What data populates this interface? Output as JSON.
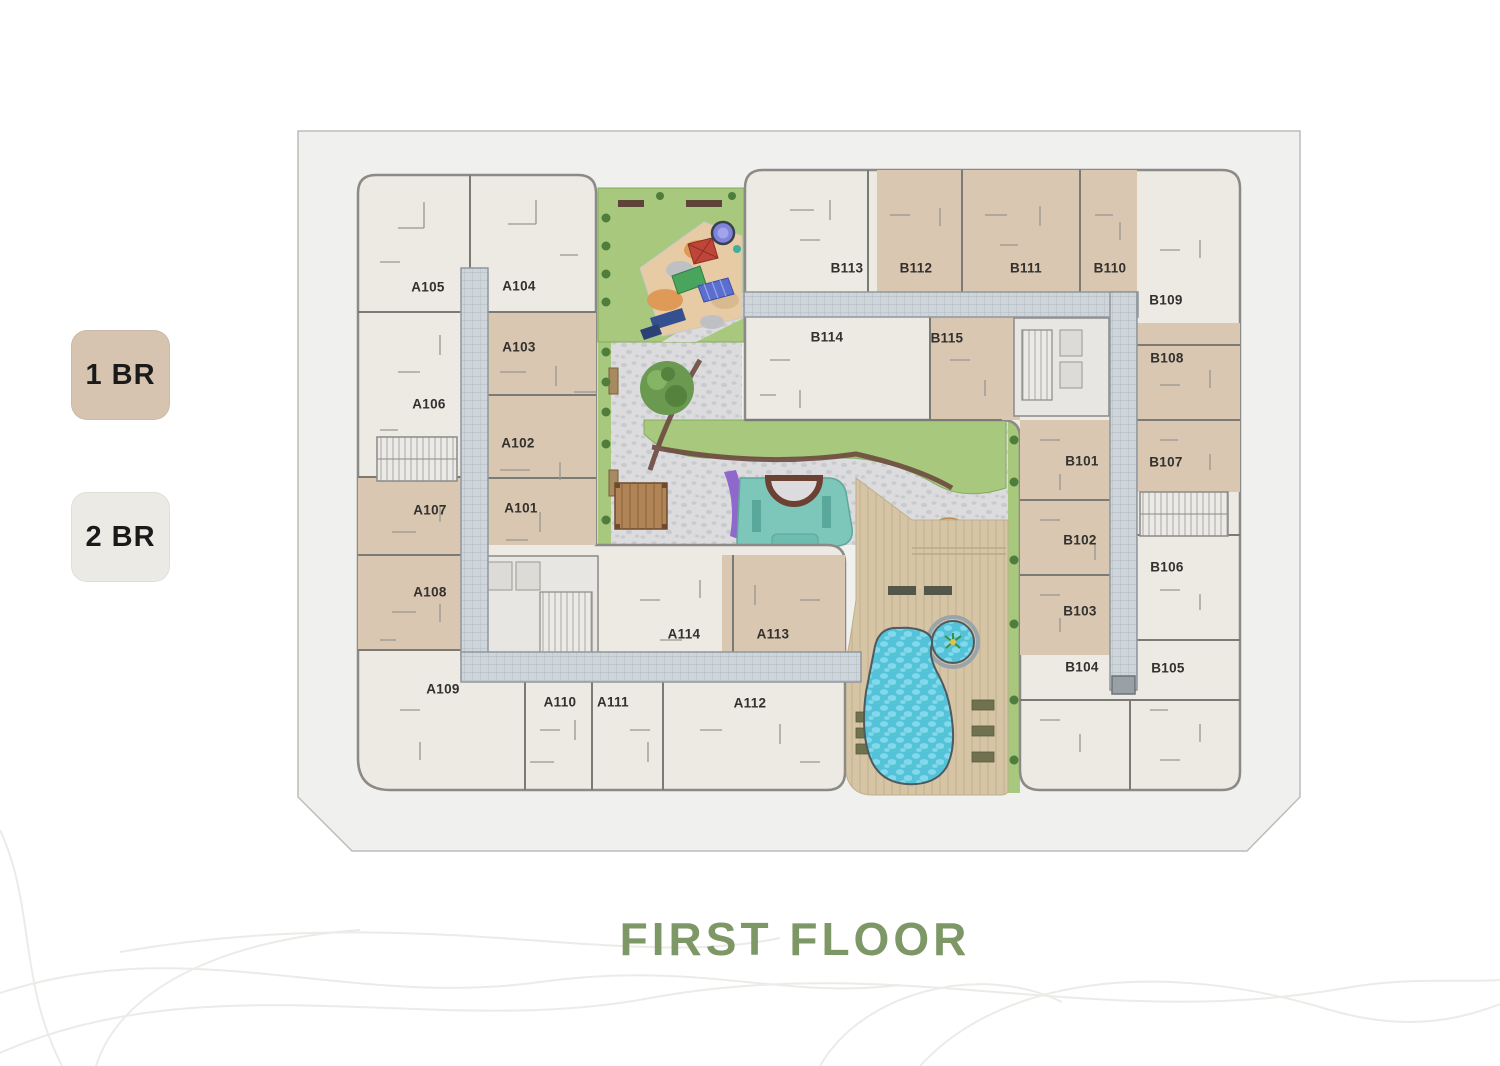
{
  "page": {
    "title": "FIRST FLOOR"
  },
  "legend": {
    "items": [
      {
        "id": "1br",
        "label": "1 BR",
        "swatch_color": "#d6c4b0"
      },
      {
        "id": "2br",
        "label": "2 BR",
        "swatch_color": "#eceae4"
      }
    ]
  },
  "floorplan": {
    "wings": [
      "A",
      "B"
    ],
    "unit_colors": {
      "1 BR": "#d9c7b2",
      "2 BR": "#edeae4"
    },
    "units": [
      {
        "label": "A105",
        "type": "2 BR",
        "x": 428,
        "y": 287
      },
      {
        "label": "A104",
        "type": "2 BR",
        "x": 519,
        "y": 286
      },
      {
        "label": "A103",
        "type": "1 BR",
        "x": 519,
        "y": 347
      },
      {
        "label": "A106",
        "type": "2 BR",
        "x": 429,
        "y": 404
      },
      {
        "label": "A102",
        "type": "1 BR",
        "x": 518,
        "y": 443
      },
      {
        "label": "A107",
        "type": "1 BR",
        "x": 430,
        "y": 510
      },
      {
        "label": "A101",
        "type": "1 BR",
        "x": 521,
        "y": 508
      },
      {
        "label": "A108",
        "type": "1 BR",
        "x": 430,
        "y": 592
      },
      {
        "label": "A109",
        "type": "2 BR",
        "x": 443,
        "y": 689
      },
      {
        "label": "A110",
        "type": "2 BR",
        "x": 560,
        "y": 702
      },
      {
        "label": "A111",
        "type": "2 BR",
        "x": 613,
        "y": 702
      },
      {
        "label": "A112",
        "type": "2 BR",
        "x": 750,
        "y": 703
      },
      {
        "label": "A114",
        "type": "2 BR",
        "x": 684,
        "y": 634
      },
      {
        "label": "A113",
        "type": "1 BR",
        "x": 773,
        "y": 634
      },
      {
        "label": "B113",
        "type": "2 BR",
        "x": 847,
        "y": 268
      },
      {
        "label": "B112",
        "type": "1 BR",
        "x": 916,
        "y": 268
      },
      {
        "label": "B111",
        "type": "1 BR",
        "x": 1026,
        "y": 268
      },
      {
        "label": "B110",
        "type": "1 BR",
        "x": 1110,
        "y": 268
      },
      {
        "label": "B109",
        "type": "2 BR",
        "x": 1166,
        "y": 300
      },
      {
        "label": "B114",
        "type": "2 BR",
        "x": 827,
        "y": 337
      },
      {
        "label": "B115",
        "type": "1 BR",
        "x": 947,
        "y": 338
      },
      {
        "label": "B108",
        "type": "1 BR",
        "x": 1167,
        "y": 358
      },
      {
        "label": "B101",
        "type": "1 BR",
        "x": 1082,
        "y": 461
      },
      {
        "label": "B107",
        "type": "1 BR",
        "x": 1166,
        "y": 462
      },
      {
        "label": "B102",
        "type": "1 BR",
        "x": 1080,
        "y": 540
      },
      {
        "label": "B106",
        "type": "2 BR",
        "x": 1167,
        "y": 567
      },
      {
        "label": "B103",
        "type": "1 BR",
        "x": 1080,
        "y": 611
      },
      {
        "label": "B104",
        "type": "1 BR",
        "x": 1082,
        "y": 667
      },
      {
        "label": "B105",
        "type": "2 BR",
        "x": 1168,
        "y": 668
      }
    ],
    "amenity_icons": [
      "playground-icon",
      "garden-courtyard-icon",
      "water-feature-icon",
      "pergola-icon",
      "parasol-icon",
      "swimming-pool-icon",
      "kids-pool-icon",
      "pool-deck-icon",
      "stair-core-icon",
      "corridor",
      "trees"
    ]
  },
  "colors": {
    "title_green": "#7d9766",
    "site_fill": "#f0f0ee",
    "wall_gray": "#7c7a74",
    "corridor": "#cfd6db",
    "lawn": "#a7c87d",
    "paving": "#dcdcde",
    "deck": "#d6c5a4",
    "pool": "#54c3da",
    "water_feature": "#7cc6ba",
    "hedge": "#6d4a3f",
    "playground_surface": "#e7cba4"
  }
}
